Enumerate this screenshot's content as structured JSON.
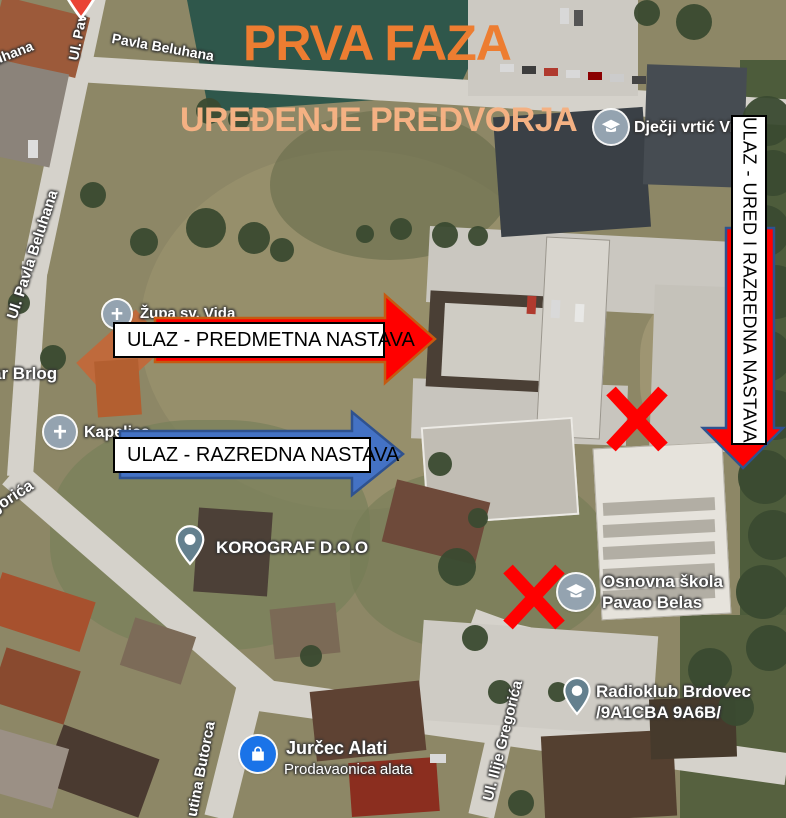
{
  "title": {
    "heading": "PRVA FAZA",
    "subheading": "UREĐENJE PREDVORJA"
  },
  "entrance_callouts": {
    "predmetna": "ULAZ - PREDMETNA NASTAVA",
    "razredna": "ULAZ - RAZREDNA NASTAVA",
    "ured_razredna": "ULAZ - URED I RAZREDNA NASTAVA"
  },
  "map": {
    "streets": {
      "pavla_beluhana_top": "Pavla Beluhana",
      "ul_pav_partial": "Ul. Pav",
      "uhana_partial": "uhana",
      "ul_pavla_beluhana": "Ul. Pavla Beluhana",
      "gorica_partial": "gorića",
      "milutina_butorca_partial": "utina Butorca",
      "ul_ilije_gregorica": "Ul. Ilije Gregorića"
    },
    "pois": {
      "zupa_sv_vida": "Župa sv. Vida",
      "ar_brlog_partial": "ar Brlog",
      "kapelica": "Kapelica",
      "korograf": "KOROGRAF D.O.O",
      "djecji_vrtic": "Dječji vrtić Vid",
      "osnovna_skola_line1": "Osnovna škola",
      "osnovna_skola_line2": "Pavao Belas",
      "radioklub_line1": "Radioklub Brdovec",
      "radioklub_line2": "/9A1CBA 9A6B/",
      "jurcec_line1": "Jurčec Alati",
      "jurcec_line2": "Prodavaonica alata"
    }
  },
  "colors": {
    "title_orange": "#ED7D31",
    "subtitle_orange": "#F4B183",
    "arrow_red": "#FF0000",
    "arrow_red_border": "#C55A11",
    "arrow_blue": "#4472C4",
    "arrow_blue_border": "#2F528F",
    "down_arrow_border": "#2F528F",
    "x_red": "#FF0000",
    "callout_bg": "#FFFFFF",
    "callout_border": "#000000"
  }
}
